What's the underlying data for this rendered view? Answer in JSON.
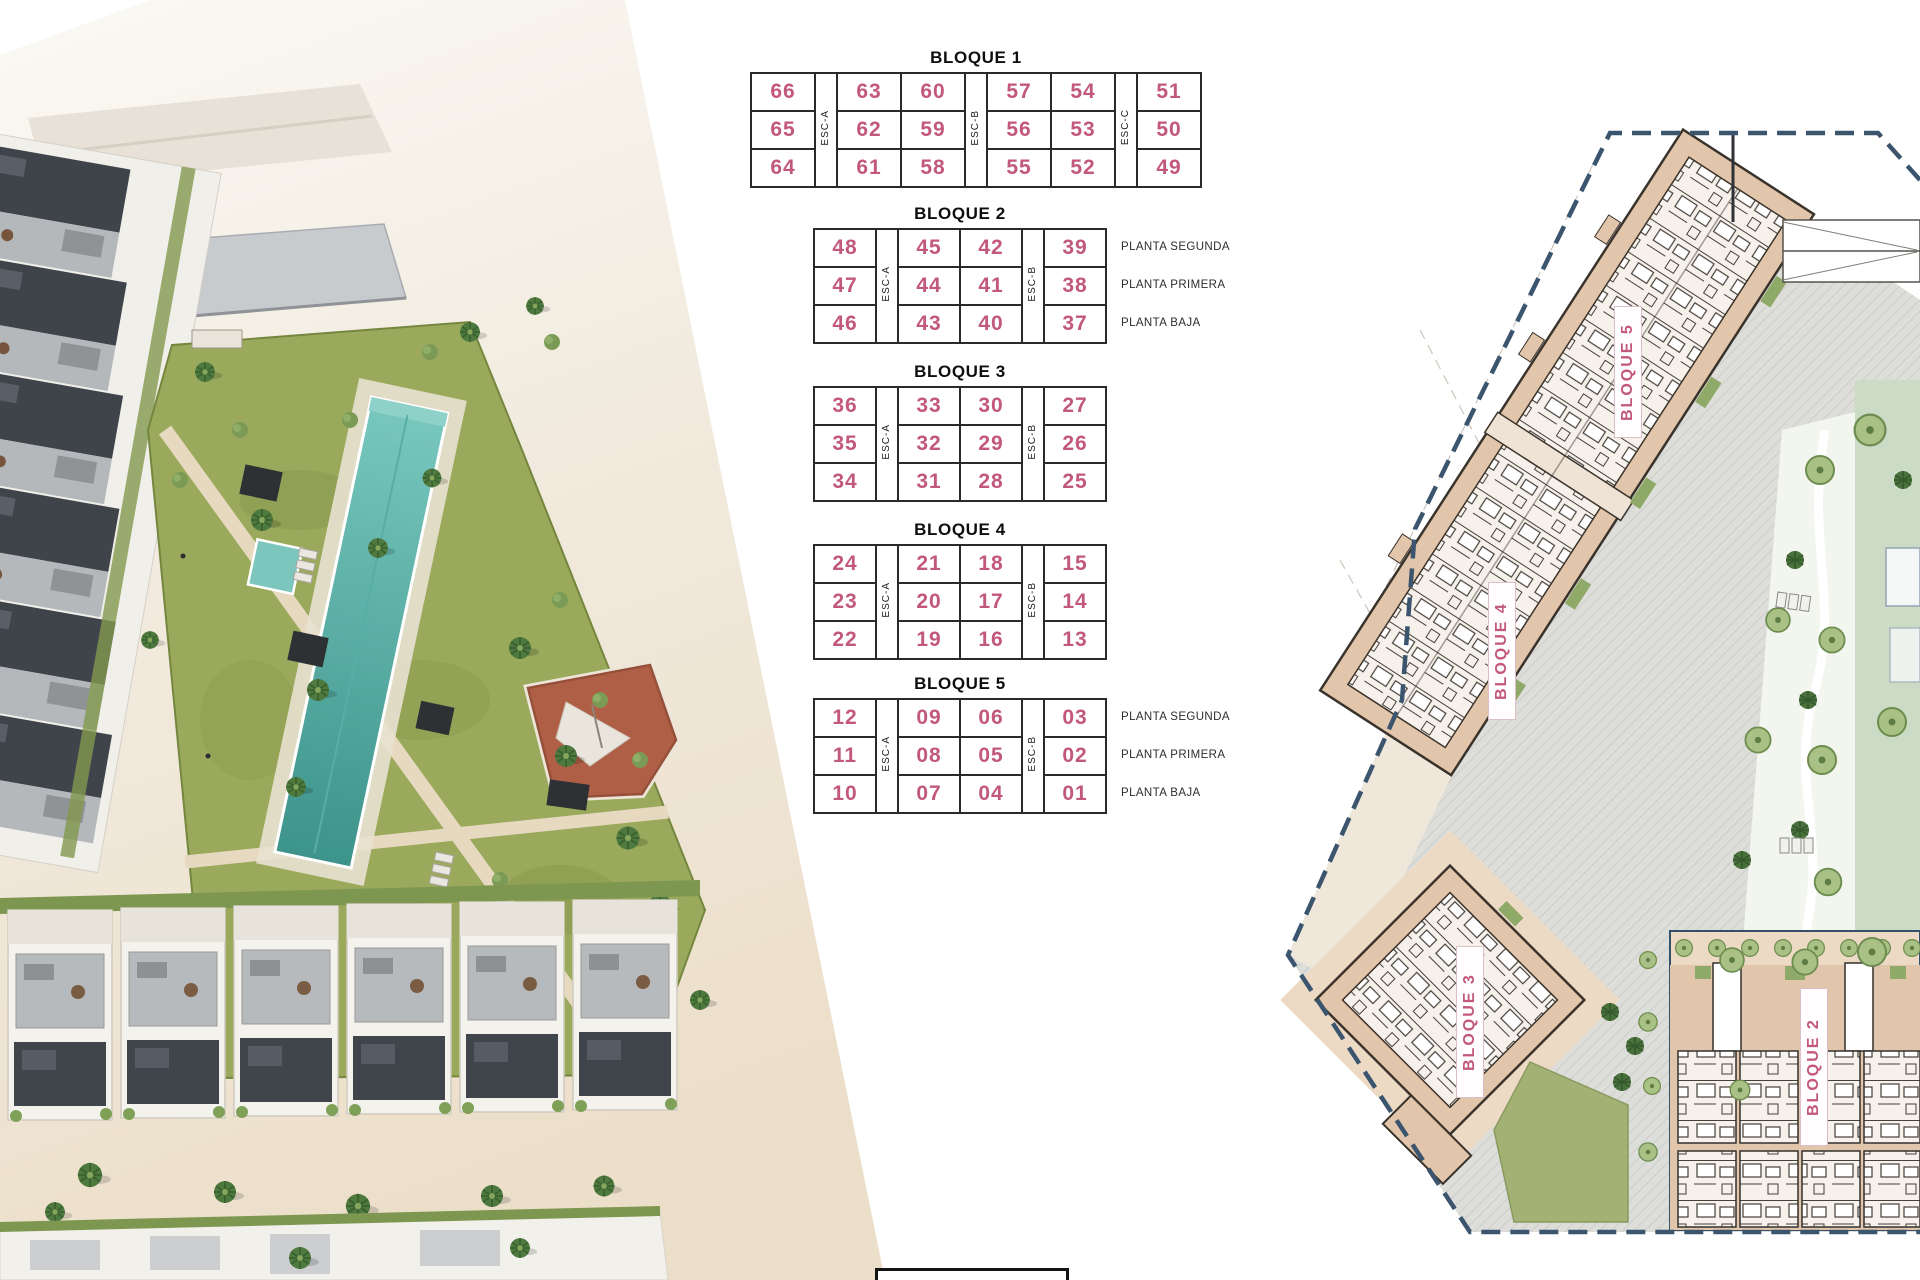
{
  "page": {
    "width": 1920,
    "height": 1280,
    "background": "#ffffff"
  },
  "colors": {
    "unit_number_pink": "#c2587a",
    "table_border": "#2a2a2a",
    "plan_building_tan": "#e2c6ab",
    "plan_boundary_navy": "#3b556f",
    "pool_turquoise": "#5ab3aa",
    "lawn_green": "#9aa95c",
    "tree_green": "#6d8c4f"
  },
  "unit_tables": {
    "blocks": [
      {
        "title": "BLOQUE 1",
        "columns": [
          {
            "type": "units",
            "values": [
              "66",
              "65",
              "64"
            ]
          },
          {
            "type": "esc",
            "label": "ESC-A"
          },
          {
            "type": "units",
            "values": [
              "63",
              "62",
              "61"
            ]
          },
          {
            "type": "units",
            "values": [
              "60",
              "59",
              "58"
            ]
          },
          {
            "type": "esc",
            "label": "ESC-B"
          },
          {
            "type": "units",
            "values": [
              "57",
              "56",
              "55"
            ]
          },
          {
            "type": "units",
            "values": [
              "54",
              "53",
              "52"
            ]
          },
          {
            "type": "esc",
            "label": "ESC-C"
          },
          {
            "type": "units",
            "values": [
              "51",
              "50",
              "49"
            ]
          }
        ],
        "planta_labels": []
      },
      {
        "title": "BLOQUE 2",
        "columns": [
          {
            "type": "units",
            "values": [
              "48",
              "47",
              "46"
            ]
          },
          {
            "type": "esc",
            "label": "ESC-A"
          },
          {
            "type": "units",
            "values": [
              "45",
              "44",
              "43"
            ]
          },
          {
            "type": "units",
            "values": [
              "42",
              "41",
              "40"
            ]
          },
          {
            "type": "esc",
            "label": "ESC-B"
          },
          {
            "type": "units",
            "values": [
              "39",
              "38",
              "37"
            ]
          }
        ],
        "planta_labels": [
          "PLANTA SEGUNDA",
          "PLANTA PRIMERA",
          "PLANTA BAJA"
        ]
      },
      {
        "title": "BLOQUE 3",
        "columns": [
          {
            "type": "units",
            "values": [
              "36",
              "35",
              "34"
            ]
          },
          {
            "type": "esc",
            "label": "ESC-A"
          },
          {
            "type": "units",
            "values": [
              "33",
              "32",
              "31"
            ]
          },
          {
            "type": "units",
            "values": [
              "30",
              "29",
              "28"
            ]
          },
          {
            "type": "esc",
            "label": "ESC-B"
          },
          {
            "type": "units",
            "values": [
              "27",
              "26",
              "25"
            ]
          }
        ],
        "planta_labels": []
      },
      {
        "title": "BLOQUE 4",
        "columns": [
          {
            "type": "units",
            "values": [
              "24",
              "23",
              "22"
            ]
          },
          {
            "type": "esc",
            "label": "ESC-A"
          },
          {
            "type": "units",
            "values": [
              "21",
              "20",
              "19"
            ]
          },
          {
            "type": "units",
            "values": [
              "18",
              "17",
              "16"
            ]
          },
          {
            "type": "esc",
            "label": "ESC-B"
          },
          {
            "type": "units",
            "values": [
              "15",
              "14",
              "13"
            ]
          }
        ],
        "planta_labels": []
      },
      {
        "title": "BLOQUE 5",
        "columns": [
          {
            "type": "units",
            "values": [
              "12",
              "11",
              "10"
            ]
          },
          {
            "type": "esc",
            "label": "ESC-A"
          },
          {
            "type": "units",
            "values": [
              "09",
              "08",
              "07"
            ]
          },
          {
            "type": "units",
            "values": [
              "06",
              "05",
              "04"
            ]
          },
          {
            "type": "esc",
            "label": "ESC-B"
          },
          {
            "type": "units",
            "values": [
              "03",
              "02",
              "01"
            ]
          }
        ],
        "planta_labels": [
          "PLANTA SEGUNDA",
          "PLANTA PRIMERA",
          "PLANTA BAJA"
        ]
      }
    ]
  },
  "site_plan": {
    "building_labels": [
      {
        "label": "BLOQUE 5"
      },
      {
        "label": "BLOQUE 4"
      },
      {
        "label": "BLOQUE 3"
      },
      {
        "label": "BLOQUE 2"
      }
    ]
  }
}
